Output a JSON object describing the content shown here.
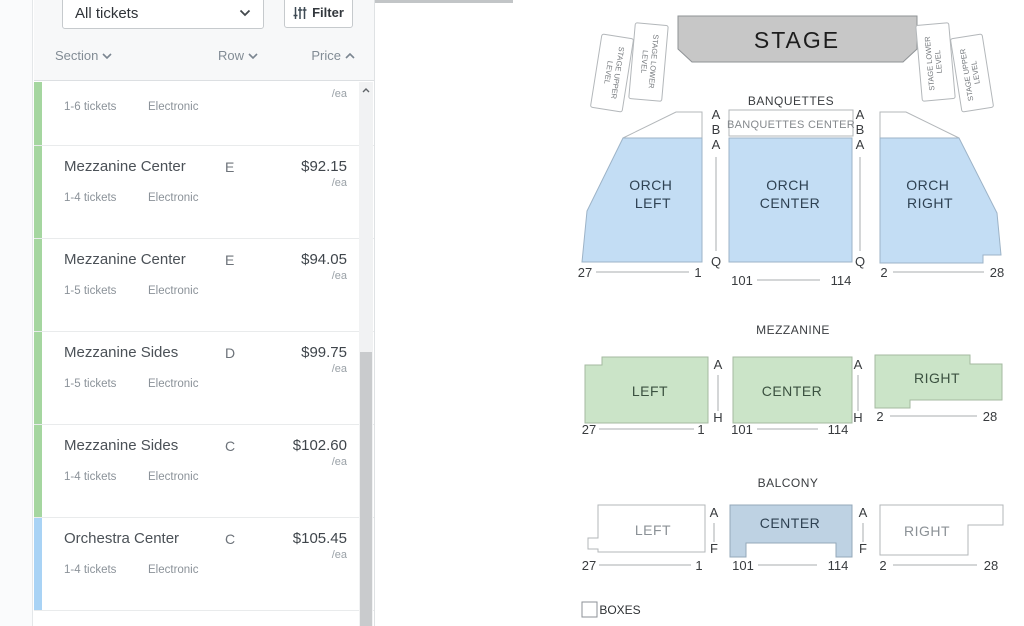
{
  "toolbar": {
    "ticket_filter_value": "All tickets",
    "filter_button_label": "Filter"
  },
  "columns": {
    "section": "Section",
    "row": "Row",
    "price": "Price"
  },
  "tickets": [
    {
      "section": "",
      "row": "",
      "price": "",
      "per_unit": "/ea",
      "quantity": "1-6 tickets",
      "delivery": "Electronic",
      "accent": "green"
    },
    {
      "section": "Mezzanine Center",
      "row": "E",
      "price": "$92.15",
      "per_unit": "/ea",
      "quantity": "1-4 tickets",
      "delivery": "Electronic",
      "accent": "green"
    },
    {
      "section": "Mezzanine Center",
      "row": "E",
      "price": "$94.05",
      "per_unit": "/ea",
      "quantity": "1-5 tickets",
      "delivery": "Electronic",
      "accent": "green"
    },
    {
      "section": "Mezzanine Sides",
      "row": "D",
      "price": "$99.75",
      "per_unit": "/ea",
      "quantity": "1-5 tickets",
      "delivery": "Electronic",
      "accent": "green"
    },
    {
      "section": "Mezzanine Sides",
      "row": "C",
      "price": "$102.60",
      "per_unit": "/ea",
      "quantity": "1-4 tickets",
      "delivery": "Electronic",
      "accent": "green"
    },
    {
      "section": "Orchestra Center",
      "row": "C",
      "price": "$105.45",
      "per_unit": "/ea",
      "quantity": "1-4 tickets",
      "delivery": "Electronic",
      "accent": "blue"
    }
  ],
  "colors": {
    "green_accent": "#a5d6a0",
    "blue_accent": "#a9d3f5",
    "orchestra_fill": "#c3ddf4",
    "mezzanine_fill": "#cbe4c8",
    "balcony_center_fill": "#bed2e3",
    "stage_fill": "#c7c7c7",
    "white_section_fill": "#ffffff"
  },
  "map": {
    "stage_label": "STAGE",
    "side_boxes": {
      "left_outer": [
        "STAGE UPPER",
        "LEVEL"
      ],
      "left_inner": [
        "STAGE LOWER",
        "LEVEL"
      ],
      "right_inner": [
        "STAGE LOWER",
        "LEVEL"
      ],
      "right_outer": [
        "STAGE UPPER",
        "LEVEL"
      ]
    },
    "banquettes": {
      "title": "BANQUETTES",
      "center_label": "BANQUETTES CENTER"
    },
    "orchestra": {
      "left": [
        "ORCH",
        "LEFT"
      ],
      "center": [
        "ORCH",
        "CENTER"
      ],
      "right": [
        "ORCH",
        "RIGHT"
      ],
      "left_rows": [
        "A",
        "B",
        "A",
        "Q"
      ],
      "right_rows": [
        "A",
        "B",
        "A",
        "Q"
      ],
      "left_seats": [
        "27",
        "1"
      ],
      "center_seats": [
        "101",
        "114"
      ],
      "right_seats": [
        "2",
        "28"
      ]
    },
    "mezzanine": {
      "title": "MEZZANINE",
      "left": "LEFT",
      "center": "CENTER",
      "right": "RIGHT",
      "left_rows": [
        "A",
        "H"
      ],
      "right_rows": [
        "A",
        "H"
      ],
      "left_seats": [
        "27",
        "1"
      ],
      "center_seats": [
        "101",
        "114"
      ],
      "right_seats": [
        "2",
        "28"
      ]
    },
    "balcony": {
      "title": "BALCONY",
      "left": "LEFT",
      "center": "CENTER",
      "right": "RIGHT",
      "left_rows": [
        "A",
        "F"
      ],
      "right_rows": [
        "A",
        "F"
      ],
      "left_seats": [
        "27",
        "1"
      ],
      "center_seats": [
        "101",
        "114"
      ],
      "right_seats": [
        "2",
        "28"
      ]
    },
    "boxes_label": "BOXES"
  }
}
